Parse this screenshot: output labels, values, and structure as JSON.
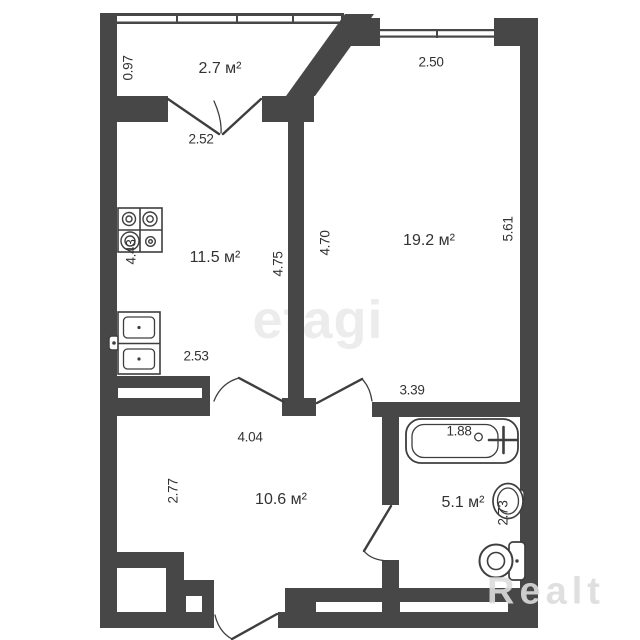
{
  "watermarks": {
    "center": "etagi",
    "corner": "Realt"
  },
  "plan": {
    "type": "apartment-floor-plan",
    "area_unit": "м²",
    "rooms": [
      {
        "name": "balcony",
        "area_label": "2.7 м²"
      },
      {
        "name": "kitchen",
        "area_label": "11.5 м²"
      },
      {
        "name": "living-room",
        "area_label": "19.2 м²"
      },
      {
        "name": "hallway",
        "area_label": "10.6 м²"
      },
      {
        "name": "bathroom",
        "area_label": "5.1 м²"
      }
    ],
    "dimensions": {
      "balcony_depth": "0.97",
      "balcony_door_width": "2.52",
      "living_window_width": "2.50",
      "kitchen_height_left": "4.43",
      "kitchen_height_right": "4.75",
      "kitchen_width_bottom": "2.53",
      "living_height_left": "4.70",
      "living_height_right": "5.61",
      "living_width_bottom": "3.39",
      "hall_width_top": "4.04",
      "hall_height_left": "2.77",
      "bathtub_length": "1.88",
      "bathroom_height": "2.73"
    },
    "fixtures": [
      "stove",
      "kitchen-sink",
      "bathtub",
      "wash-basin",
      "toilet"
    ],
    "colors": {
      "wall": "#474747",
      "line": "#3e3e3e",
      "text": "#333333",
      "watermark_center": "#ececec",
      "watermark_corner": "#dcdcdc",
      "background": "#ffffff"
    }
  }
}
